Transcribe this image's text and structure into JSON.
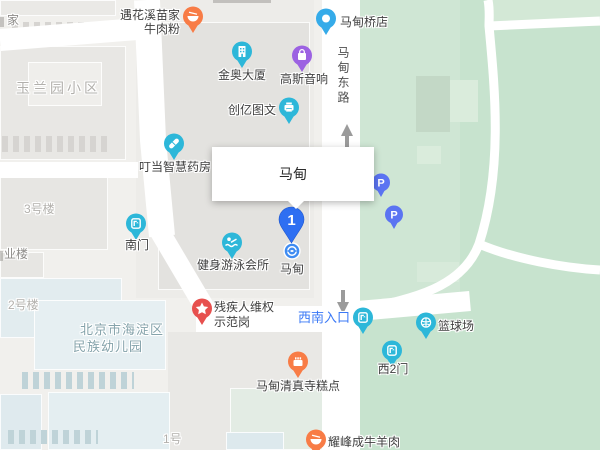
{
  "popup": {
    "title": "马甸"
  },
  "pin": {
    "number": "1"
  },
  "station": {
    "name": "马甸"
  },
  "road": {
    "name": "马甸东路"
  },
  "parking": {
    "label": "P"
  },
  "pois": {
    "beef1": "遇花溪苗家",
    "beef2": "牛肉粉",
    "bridge": "马甸桥店",
    "jinao": "金奥大厦",
    "gauss": "高斯音响",
    "print": "创亿图文",
    "pharmacy": "叮当智慧药房",
    "gym": "健身游泳会所",
    "rights1": "残疾人维权",
    "rights2": "示范岗",
    "bakery": "马甸清真寺糕点",
    "lamb": "耀峰成牛羊肉",
    "court": "篮球场"
  },
  "gates": {
    "south": "南门",
    "southwest": "西南入口",
    "west2": "西2门"
  },
  "areas": {
    "yulan": "玉兰园小区",
    "b3": "3号楼",
    "b2": "2号楼",
    "b1": "1号",
    "yelou": "业楼",
    "jia": "家",
    "kinder1": "北京市海淀区",
    "kinder2": "民族幼儿园"
  },
  "colors": {
    "selected_pin": "#2e6ff2",
    "teal_marker": "#2db7d9",
    "orange_marker": "#f87c46",
    "red_marker": "#e7504e",
    "purple_marker": "#9c62e2",
    "parking_marker": "#5b74f2",
    "blue_pin": "#35abe9",
    "entrance_text": "#3b79f6",
    "park_green": "#c7e3ce",
    "road_white": "#ffffff"
  }
}
